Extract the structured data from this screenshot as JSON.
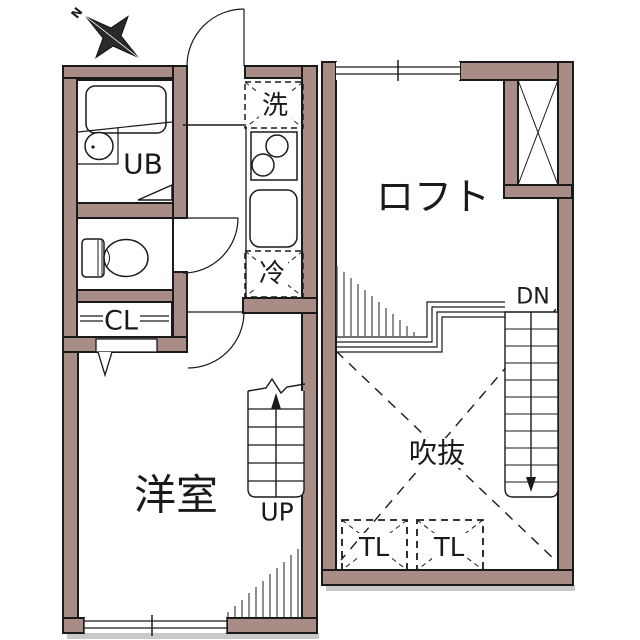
{
  "plan": {
    "compass": {
      "north": "N"
    },
    "first_floor": {
      "unit_bath": "UB",
      "closet": "CL",
      "western_room": "洋室",
      "stairs_up": "UP",
      "washing_machine": "洗",
      "refrigerator": "冷"
    },
    "loft_floor": {
      "loft": "ロフト",
      "stairs_down": "DN",
      "void": "吹抜",
      "toplight_1": "TL",
      "toplight_2": "TL"
    }
  },
  "colors": {
    "wall": "#a78d85",
    "outline": "#1a1a1a",
    "background": "#ffffff",
    "shadow": "#c9c9c9"
  }
}
